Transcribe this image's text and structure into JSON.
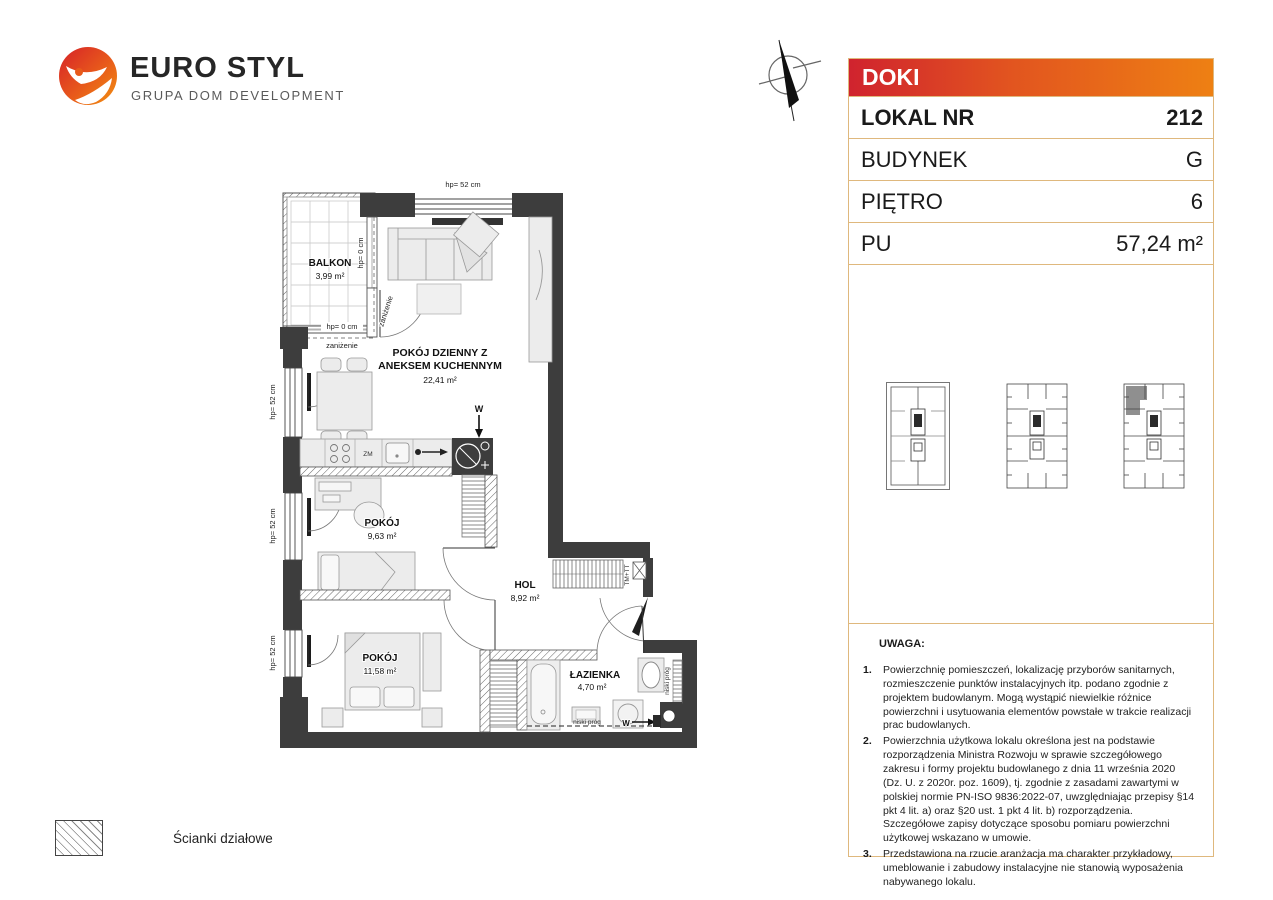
{
  "brand": {
    "name": "EURO STYL",
    "tagline": "GRUPA DOM DEVELOPMENT"
  },
  "info": {
    "project": "DOKI",
    "rows": [
      {
        "label": "LOKAL NR",
        "value": "212"
      },
      {
        "label": "BUDYNEK",
        "value": "G"
      },
      {
        "label": "PIĘTRO",
        "value": "6"
      },
      {
        "label": "PU",
        "value": "57,24 m²"
      }
    ]
  },
  "plan": {
    "rooms": {
      "balkon": {
        "name": "BALKON",
        "area": "3,99 m²"
      },
      "living": {
        "name_line1": "POKÓJ DZIENNY Z",
        "name_line2": "ANEKSEM KUCHENNYM",
        "area": "22,41 m²"
      },
      "pokoj1": {
        "name": "POKÓJ",
        "area": "9,63 m²"
      },
      "hol": {
        "name": "HOL",
        "area": "8,92 m²"
      },
      "pokoj2": {
        "name": "POKÓJ",
        "area": "11,58 m²"
      },
      "lazienka": {
        "name": "ŁAZIENKA",
        "area": "4,70 m²"
      }
    },
    "annotations": {
      "hp52": "hp= 52 cm",
      "hp0": "hp= 0 cm",
      "zanizenie": "zaniżenie",
      "niski_prog": "niski próg",
      "shaft": "TM+TT",
      "zm": "ZM",
      "vent": "W"
    }
  },
  "legend": {
    "label": "Ścianki działowe"
  },
  "notes": {
    "title": "UWAGA:",
    "items": [
      {
        "num": "1.",
        "text": "Powierzchnię pomieszczeń, lokalizację przyborów sanitarnych, rozmieszczenie punktów instalacyjnych itp. podano zgodnie z projektem budowlanym. Mogą wystąpić niewielkie różnice powierzchni i usytuowania elementów powstałe w trakcie realizacji prac budowlanych."
      },
      {
        "num": "2.",
        "text": "Powierzchnia użytkowa lokalu określona jest na podstawie rozporządzenia Ministra Rozwoju w sprawie szczegółowego zakresu i formy projektu budowlanego z dnia 11 września 2020 (Dz. U. z 2020r. poz. 1609), tj. zgodnie z zasadami zawartymi w polskiej normie PN-ISO 9836:2022-07, uwzględniając przepisy §14 pkt 4 lit. a) oraz §20 ust. 1 pkt 4 lit. b) rozporządzenia. Szczegółowe zapisy dotyczące sposobu pomiaru powierzchni użytkowej wskazano w umowie."
      },
      {
        "num": "3.",
        "text": "Przedstawiona na rzucie aranżacja ma charakter przykładowy, umeblowanie i zabudowy instalacyjne nie stanowią wyposażenia nabywanego lokalu."
      }
    ]
  },
  "colors": {
    "accent_red": "#d0232e",
    "accent_orange": "#ee8013",
    "table_border": "#dfb87d",
    "wall": "#3d3d3d"
  }
}
